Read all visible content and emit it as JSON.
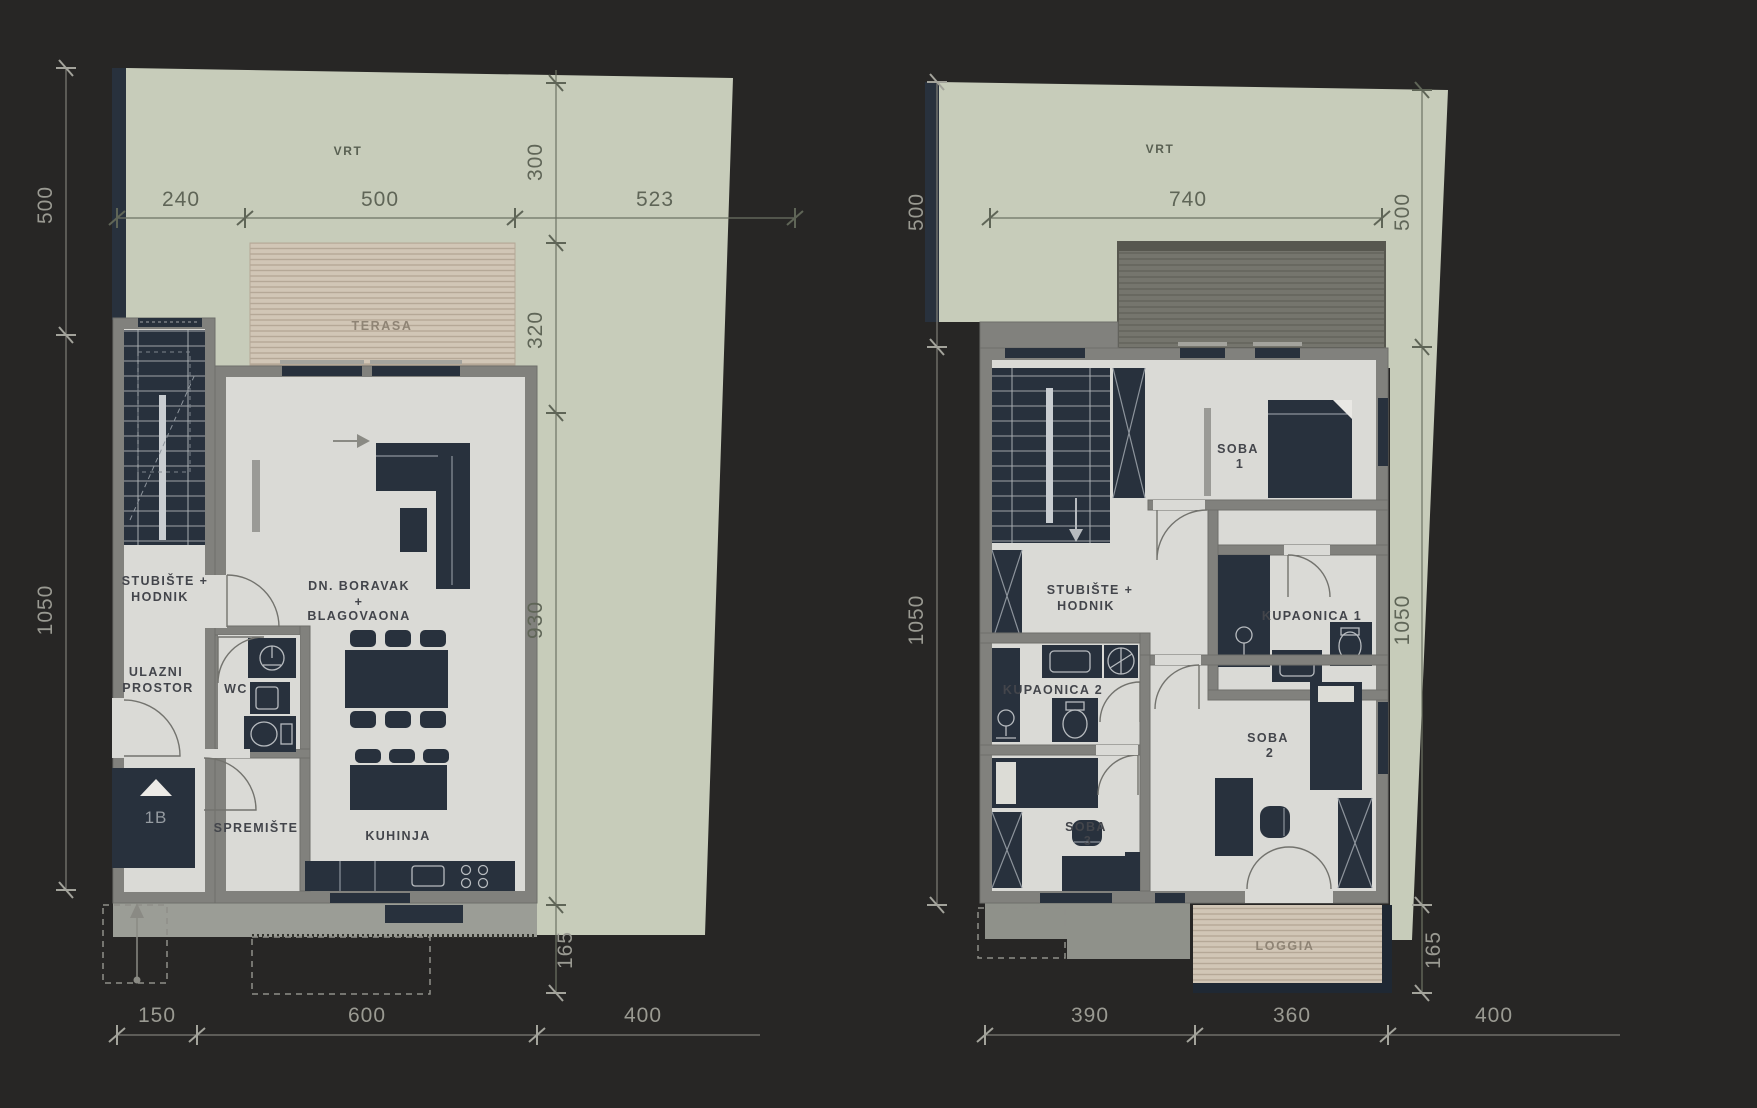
{
  "title": "Floor plans – two storeys of a residential unit",
  "colors": {
    "background": "#272625",
    "garden": "#c7ccba",
    "terrace": "#d1c6b6",
    "terrace_stripe": "#b5a897",
    "roof_deck": "#75756d",
    "roof_stripe": "#62625a",
    "wall": "#81817d",
    "floor": "#dadad6",
    "fixtures_navy": "#28313d",
    "pavement": "#9b9d96"
  },
  "plans": {
    "left": {
      "garden": "VRT",
      "terrace": "TERASA",
      "stairs1": "STUBIŠTE +",
      "stairs2": "HODNIK",
      "entry1": "ULAZNI",
      "entry2": "PROSTOR",
      "wc": "WC",
      "storage": "SPREMIŠTE",
      "living1": "DN. BORAVAK",
      "living2": "+",
      "living3": "BLAGOVAONA",
      "kitchen": "KUHINJA",
      "unit": "1B",
      "dims": {
        "top": [
          "240",
          "500",
          "523"
        ],
        "left": [
          "500",
          "1050"
        ],
        "middle": [
          "300",
          "320",
          "930",
          "165"
        ],
        "bottom": [
          "150",
          "600",
          "400"
        ]
      }
    },
    "right": {
      "garden": "VRT",
      "room1a": "SOBA",
      "room1b": "1",
      "stairs1": "STUBIŠTE +",
      "stairs2": "HODNIK",
      "bath1": "KUPAONICA 1",
      "bath2": "KUPAONICA 2",
      "room2a": "SOBA",
      "room2b": "2",
      "room3a": "SOBA",
      "room3b": "3",
      "loggia": "LOGGIA",
      "dims": {
        "top": [
          "740"
        ],
        "left": [
          "500",
          "1050"
        ],
        "right": [
          "500",
          "1050",
          "165"
        ],
        "bottom": [
          "390",
          "360",
          "400"
        ]
      }
    }
  }
}
